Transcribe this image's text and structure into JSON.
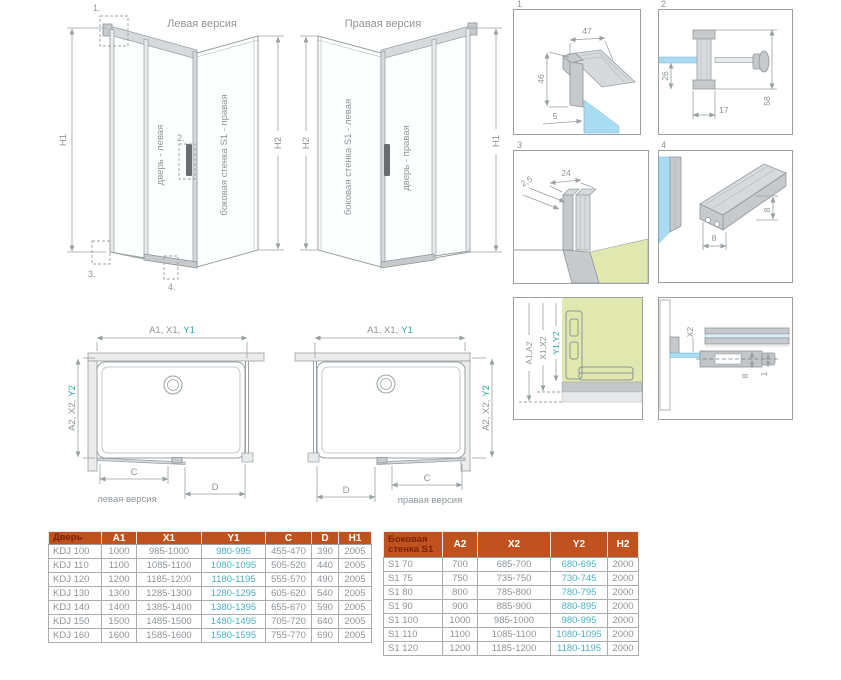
{
  "colors": {
    "header_bg": "#c0521f",
    "header_text": "#ffffff",
    "header_first_text": "#7c2306",
    "table_text": "#8e9499",
    "table_accent": "#4bb1c5",
    "drawing_line": "#98a0a4",
    "drawing_text": "#8e959a",
    "teal_label": "#2fa89f",
    "glass_blue": "#a9dcf2",
    "wall_green": "#e0e8af",
    "profile_gray": "#c6cacd"
  },
  "views3d": {
    "left": {
      "title": "Левая версия",
      "door_label": "дверь - левая",
      "wall_label": "боковая стенка S1 - правая",
      "h_left": "H1",
      "h_right": "H2",
      "callout1": "1.",
      "callout2": "2.",
      "callout3": "3.",
      "callout4": "4."
    },
    "right": {
      "title": "Правая версия",
      "door_label": "дверь - правая",
      "wall_label": "боковая стенка S1 - левая",
      "h_left": "H2",
      "h_right": "H1"
    }
  },
  "plans": {
    "left": {
      "top_dim_prefix": "A1, X1,",
      "top_dim_accent": "Y1",
      "side_dim_prefix": "A2, X2,",
      "side_dim_accent": "Y2",
      "c_label": "C",
      "d_label": "D",
      "caption": "левая версия"
    },
    "right": {
      "top_dim_prefix": "A1, X1,",
      "top_dim_accent": "Y1",
      "side_dim_prefix": "A2, X2,",
      "side_dim_accent": "Y2",
      "c_label": "C",
      "d_label": "D",
      "caption": "правая версия"
    }
  },
  "details": {
    "d1": {
      "num": "1",
      "dim_width": "47",
      "dim_height": "46",
      "dim_glass": "5"
    },
    "d2": {
      "num": "2",
      "dim_below": "26",
      "dim_bracket": "17",
      "dim_total": "58"
    },
    "d3": {
      "num": "3",
      "dim_thickness": "2,5",
      "dim_width": "24"
    },
    "d4": {
      "num": "4",
      "dim_height": "8",
      "dim_width": "8"
    },
    "d5": {
      "dim_a": "A1,A2",
      "dim_x": "X1,X2",
      "dim_y": "Y1,Y2"
    },
    "d6": {
      "dim_x2": "X2",
      "dim_8": "8",
      "dim_1": "1"
    }
  },
  "door_table": {
    "headers": [
      "Дверь",
      "A1",
      "X1",
      "Y1",
      "C",
      "D",
      "H1"
    ],
    "rows": [
      [
        "KDJ 100",
        "1000",
        "985-1000",
        "980-995",
        "455-470",
        "390",
        "2005"
      ],
      [
        "KDJ 110",
        "1100",
        "1085-1100",
        "1080-1095",
        "505-520",
        "440",
        "2005"
      ],
      [
        "KDJ 120",
        "1200",
        "1185-1200",
        "1180-1195",
        "555-570",
        "490",
        "2005"
      ],
      [
        "KDJ 130",
        "1300",
        "1285-1300",
        "1280-1295",
        "605-620",
        "540",
        "2005"
      ],
      [
        "KDJ 140",
        "1400",
        "1385-1400",
        "1380-1395",
        "655-670",
        "590",
        "2005"
      ],
      [
        "KDJ 150",
        "1500",
        "1485-1500",
        "1480-1495",
        "705-720",
        "640",
        "2005"
      ],
      [
        "KDJ 160",
        "1600",
        "1585-1600",
        "1580-1595",
        "755-770",
        "690",
        "2005"
      ]
    ],
    "accent_col": 3
  },
  "side_table": {
    "headers": [
      "Боковая стенка S1",
      "A2",
      "X2",
      "Y2",
      "H2"
    ],
    "rows": [
      [
        "S1 70",
        "700",
        "685-700",
        "680-695",
        "2000"
      ],
      [
        "S1 75",
        "750",
        "735-750",
        "730-745",
        "2000"
      ],
      [
        "S1 80",
        "800",
        "785-800",
        "780-795",
        "2000"
      ],
      [
        "S1 90",
        "900",
        "885-900",
        "880-895",
        "2000"
      ],
      [
        "S1 100",
        "1000",
        "985-1000",
        "980-995",
        "2000"
      ],
      [
        "S1 110",
        "1100",
        "1085-1100",
        "1080-1095",
        "2000"
      ],
      [
        "S1 120",
        "1200",
        "1185-1200",
        "1180-1195",
        "2000"
      ]
    ],
    "accent_col": 3
  }
}
